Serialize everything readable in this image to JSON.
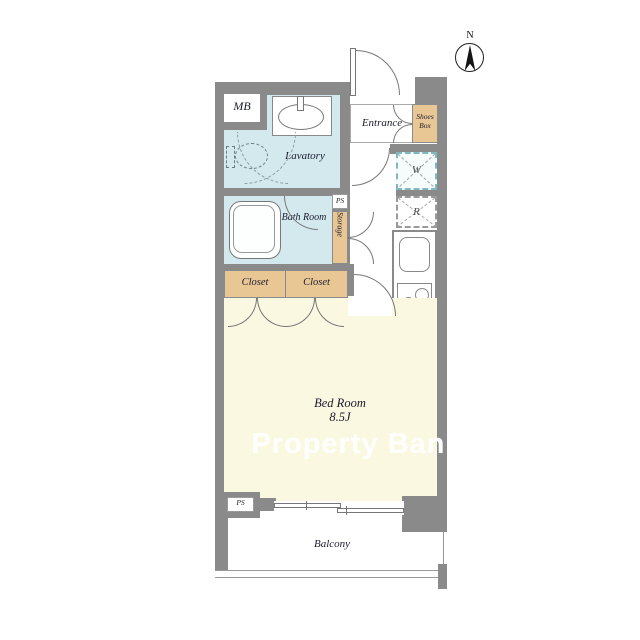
{
  "watermark": "Property Bank",
  "compass": {
    "label": "N"
  },
  "rooms": {
    "mb": "MB",
    "lavatory": "Lavatory",
    "bath": "Bath Room",
    "ps_top": "PS",
    "storage": "Storage",
    "entrance": "Entrance",
    "shoes_box": "Shoes Box",
    "washer": "W",
    "fridge": "R",
    "closet_left": "Closet",
    "closet_right": "Closet",
    "bedroom_name": "Bed Room",
    "bedroom_size": "8.5J",
    "ps_bottom": "PS",
    "balcony": "Balcony"
  },
  "colors": {
    "wall_gray": "#8a8a8a",
    "wet_area_blue": "#d4e9ee",
    "storage_tan": "#e8c795",
    "bedroom_cream": "#fbf8e2",
    "washer_dash_teal": "#7fb7c4"
  }
}
